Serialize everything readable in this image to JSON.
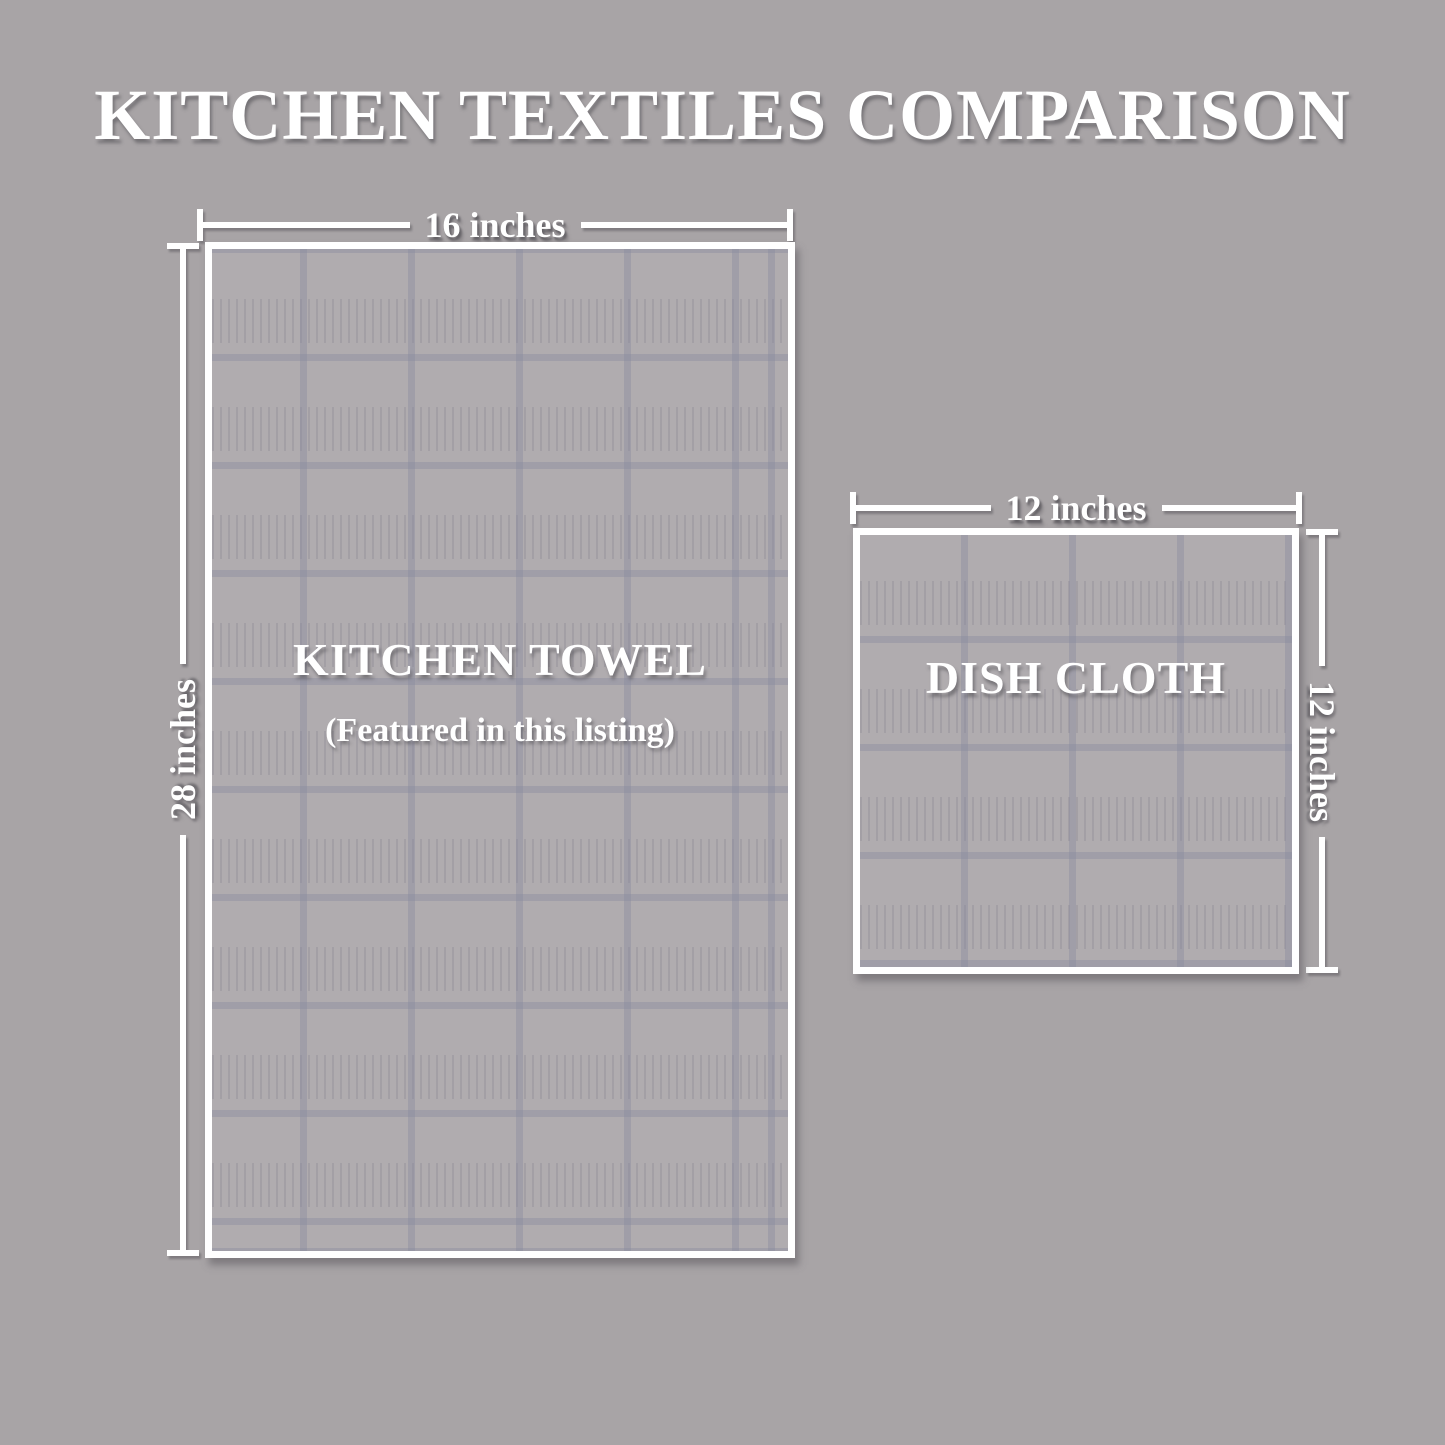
{
  "title": "KITCHEN TEXTILES COMPARISON",
  "kitchen_towel": {
    "label": "KITCHEN TOWEL",
    "sublabel": "(Featured in this listing)",
    "width_label": "16 inches",
    "height_label": "28 inches",
    "width_inches": 16,
    "height_inches": 28
  },
  "dish_cloth": {
    "label": "DISH CLOTH",
    "width_label": "12 inches",
    "height_label": "12 inches",
    "width_inches": 12,
    "height_inches": 12
  },
  "colors": {
    "background": "#a8a4a6",
    "cloth_fill": "#b0acaf",
    "grid_line": "#898a9e",
    "text": "#ffffff"
  }
}
